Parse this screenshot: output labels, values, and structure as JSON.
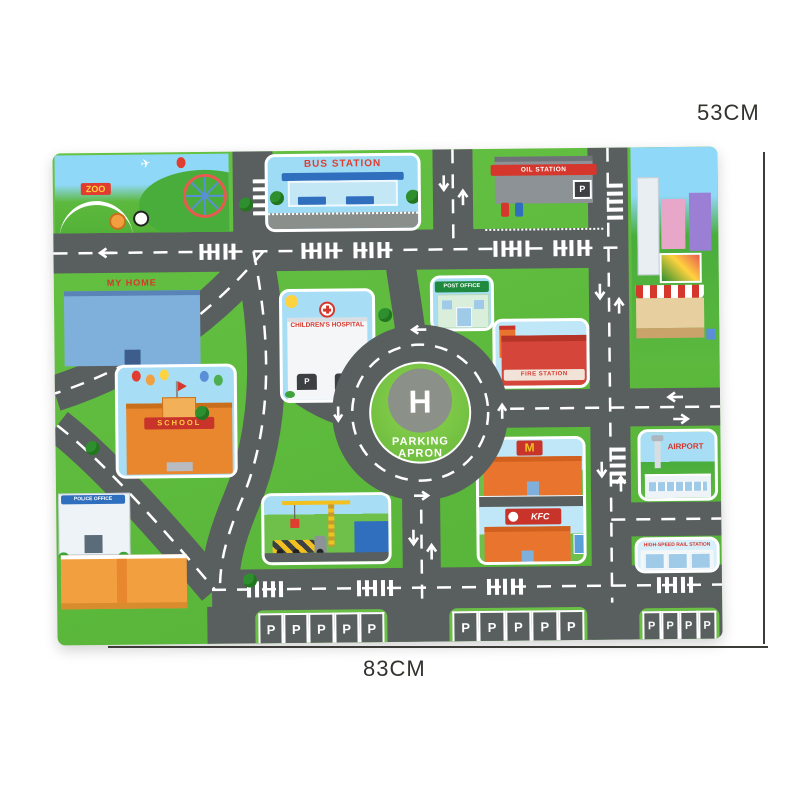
{
  "dimensions": {
    "height_label": "53CM",
    "width_label": "83CM"
  },
  "mat": {
    "colors": {
      "road": "#595f5e",
      "grass": "#5fbe3b",
      "sky": "#8ed7f5",
      "marking": "#ffffff",
      "sign_red": "#d6372c",
      "sign_green": "#1f8a3e",
      "helipad_green": "#74c241",
      "helipad_pad": "#8b9089"
    },
    "zoo": {
      "sign": "ZOO"
    },
    "bus_station": {
      "name": "BUS STATION"
    },
    "oil_station": {
      "name": "OIL STATION",
      "parking_sign": "P"
    },
    "my_home": {
      "name": "MY HOME"
    },
    "hospital": {
      "name": "CHILDREN'S HOSPITAL",
      "garage_sign": "P"
    },
    "post_office": {
      "name": "POST OFFICE"
    },
    "fire_station": {
      "name": "FIRE STATION"
    },
    "school": {
      "name": "SCHOOL"
    },
    "police_office": {
      "name": "POLICE OFFICE"
    },
    "restaurants": {
      "mcdonalds_sign": "M",
      "kfc_sign": "KFC"
    },
    "airport": {
      "name": "AIRPORT"
    },
    "rail_station": {
      "name": "HIGH-SPEED RAIL STATION"
    },
    "helipad": {
      "letter": "H",
      "label_line1": "PARKING",
      "label_line2": "APRON"
    },
    "parking": {
      "stall_letter": "P"
    }
  }
}
